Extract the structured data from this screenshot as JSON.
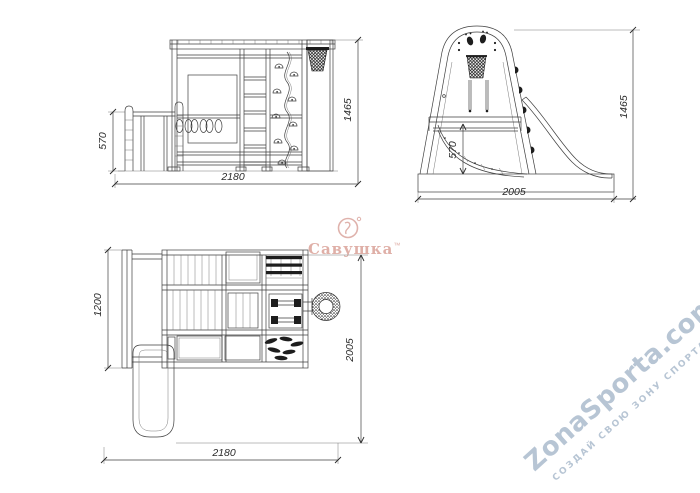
{
  "drawing": {
    "line_color": "#3f3f3f",
    "front_view": {
      "width": "2180",
      "height": "1465",
      "slide_height": "570"
    },
    "side_view": {
      "width": "2005",
      "height": "1465",
      "platform_height": "570"
    },
    "plan_view": {
      "width": "2180",
      "depth": "2005",
      "rear_section": "1200"
    }
  },
  "watermarks": {
    "brand": {
      "text": "Савушка",
      "tm": "™",
      "color": "#d89c92"
    },
    "site": {
      "title": "ZonaSporta.com",
      "subtitle": "СОЗДАЙ СВОЮ ЗОНУ СПОРТА",
      "color": "#b7c5d4"
    }
  }
}
